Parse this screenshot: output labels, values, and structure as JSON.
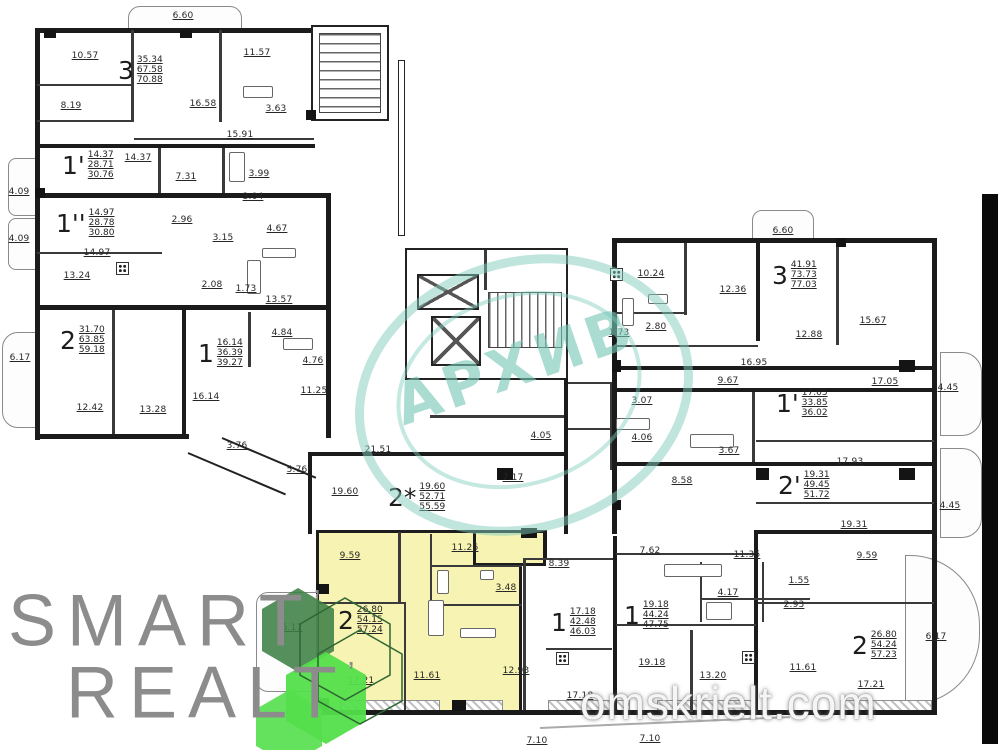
{
  "branding": {
    "logo_line1": "SMART",
    "logo_line2": "REALT",
    "logo_tick": "’",
    "stamp_text": "АРХИВ",
    "site_watermark": "omskrielt.com"
  },
  "colors": {
    "highlight_yellow": "#f7f3b2",
    "stamp_teal": "#7fcbbc",
    "hex_dark_green": "#3e8044",
    "hex_bright_green": "#54df4b",
    "wall_black": "#1b1b1b",
    "logo_gray": "#8c8c8c"
  },
  "apartments": [
    {
      "id": "apt-3-top-left",
      "number": "3",
      "values": [
        "35.34",
        "67.58",
        "70.88"
      ],
      "x": 118,
      "y": 55
    },
    {
      "id": "apt-1p-left",
      "number": "1'",
      "values": [
        "14.37",
        "28.71",
        "30.76"
      ],
      "x": 62,
      "y": 150
    },
    {
      "id": "apt-1pp-left",
      "number": "1''",
      "values": [
        "14.97",
        "28.78",
        "30.80"
      ],
      "x": 56,
      "y": 208
    },
    {
      "id": "apt-2-left",
      "number": "2",
      "values": [
        "31.70",
        "63.85",
        "59.18"
      ],
      "x": 60,
      "y": 325
    },
    {
      "id": "apt-1-left",
      "number": "1",
      "values": [
        "16.14",
        "36.39",
        "39.27"
      ],
      "x": 198,
      "y": 338
    },
    {
      "id": "apt-2star-center",
      "number": "2*",
      "values": [
        "19.60",
        "52.71",
        "55.59"
      ],
      "x": 388,
      "y": 482
    },
    {
      "id": "apt-3-right",
      "number": "3",
      "values": [
        "41.91",
        "73.73",
        "77.03"
      ],
      "x": 772,
      "y": 260
    },
    {
      "id": "apt-1p-right",
      "number": "1'",
      "values": [
        "17.05",
        "33.85",
        "36.02"
      ],
      "x": 776,
      "y": 388
    },
    {
      "id": "apt-2p-right",
      "number": "2'",
      "values": [
        "19.31",
        "49.45",
        "51.72"
      ],
      "x": 778,
      "y": 470
    },
    {
      "id": "apt-2-highlight",
      "number": "2",
      "values": [
        "26.80",
        "54.15",
        "57.24"
      ],
      "x": 338,
      "y": 605
    },
    {
      "id": "apt-1-bottom-a",
      "number": "1",
      "values": [
        "17.18",
        "42.48",
        "46.03"
      ],
      "x": 551,
      "y": 607
    },
    {
      "id": "apt-1-bottom-b",
      "number": "1",
      "values": [
        "19.18",
        "44.24",
        "47.75"
      ],
      "x": 624,
      "y": 600
    },
    {
      "id": "apt-2-bottom-right",
      "number": "2",
      "values": [
        "26.80",
        "54.24",
        "57.23"
      ],
      "x": 852,
      "y": 630
    }
  ],
  "room_labels": [
    {
      "t": "6.60",
      "x": 183,
      "y": 16
    },
    {
      "t": "10.57",
      "x": 85,
      "y": 56
    },
    {
      "t": "11.57",
      "x": 257,
      "y": 53
    },
    {
      "t": "16.58",
      "x": 203,
      "y": 104
    },
    {
      "t": "8.19",
      "x": 71,
      "y": 106
    },
    {
      "t": "3.63",
      "x": 276,
      "y": 109
    },
    {
      "t": "15.91",
      "x": 240,
      "y": 135
    },
    {
      "t": "14.37",
      "x": 138,
      "y": 158
    },
    {
      "t": "7.31",
      "x": 186,
      "y": 177
    },
    {
      "t": "3.99",
      "x": 259,
      "y": 174
    },
    {
      "t": "3.04",
      "x": 253,
      "y": 197
    },
    {
      "t": "4.09",
      "x": 19,
      "y": 192
    },
    {
      "t": "4.09",
      "x": 19,
      "y": 239
    },
    {
      "t": "14.97",
      "x": 97,
      "y": 253
    },
    {
      "t": "2.96",
      "x": 182,
      "y": 220
    },
    {
      "t": "3.15",
      "x": 223,
      "y": 238
    },
    {
      "t": "4.67",
      "x": 277,
      "y": 229
    },
    {
      "t": "2.08",
      "x": 212,
      "y": 285
    },
    {
      "t": "1.73",
      "x": 246,
      "y": 289
    },
    {
      "t": "13.24",
      "x": 77,
      "y": 276
    },
    {
      "t": "13.57",
      "x": 279,
      "y": 300
    },
    {
      "t": "6.17",
      "x": 20,
      "y": 358
    },
    {
      "t": "12.42",
      "x": 90,
      "y": 408
    },
    {
      "t": "13.28",
      "x": 153,
      "y": 410
    },
    {
      "t": "16.14",
      "x": 206,
      "y": 397
    },
    {
      "t": "4.84",
      "x": 282,
      "y": 333
    },
    {
      "t": "4.76",
      "x": 313,
      "y": 361
    },
    {
      "t": "11.25",
      "x": 314,
      "y": 391
    },
    {
      "t": "3.76",
      "x": 237,
      "y": 446
    },
    {
      "t": "5.76",
      "x": 297,
      "y": 470
    },
    {
      "t": "21.51",
      "x": 378,
      "y": 450
    },
    {
      "t": "4.05",
      "x": 541,
      "y": 436
    },
    {
      "t": "7.17",
      "x": 513,
      "y": 478
    },
    {
      "t": "19.60",
      "x": 345,
      "y": 492
    },
    {
      "t": "11.26",
      "x": 465,
      "y": 548
    },
    {
      "t": "9.59",
      "x": 350,
      "y": 556
    },
    {
      "t": "3.48",
      "x": 506,
      "y": 588
    },
    {
      "t": "11.61",
      "x": 427,
      "y": 676
    },
    {
      "t": "17.21",
      "x": 361,
      "y": 681
    },
    {
      "t": "8.39",
      "x": 559,
      "y": 564
    },
    {
      "t": "6.17",
      "x": 292,
      "y": 628
    },
    {
      "t": "12.93",
      "x": 516,
      "y": 671
    },
    {
      "t": "17.18",
      "x": 580,
      "y": 696
    },
    {
      "t": "7.10",
      "x": 537,
      "y": 741
    },
    {
      "t": "7.10",
      "x": 650,
      "y": 739
    },
    {
      "t": "6.60",
      "x": 783,
      "y": 231
    },
    {
      "t": "10.24",
      "x": 651,
      "y": 274
    },
    {
      "t": "12.36",
      "x": 733,
      "y": 290
    },
    {
      "t": "2.80",
      "x": 656,
      "y": 327
    },
    {
      "t": "1.73",
      "x": 619,
      "y": 333
    },
    {
      "t": "15.67",
      "x": 873,
      "y": 321
    },
    {
      "t": "12.88",
      "x": 809,
      "y": 335
    },
    {
      "t": "16.95",
      "x": 754,
      "y": 363
    },
    {
      "t": "9.67",
      "x": 728,
      "y": 381
    },
    {
      "t": "17.05",
      "x": 885,
      "y": 382
    },
    {
      "t": "3.07",
      "x": 642,
      "y": 401
    },
    {
      "t": "4.06",
      "x": 642,
      "y": 438
    },
    {
      "t": "3.67",
      "x": 729,
      "y": 451
    },
    {
      "t": "17.93",
      "x": 850,
      "y": 462
    },
    {
      "t": "8.58",
      "x": 682,
      "y": 481
    },
    {
      "t": "19.31",
      "x": 854,
      "y": 525
    },
    {
      "t": "4.45",
      "x": 948,
      "y": 388
    },
    {
      "t": "4.45",
      "x": 950,
      "y": 506
    },
    {
      "t": "7.62",
      "x": 650,
      "y": 551
    },
    {
      "t": "11.35",
      "x": 747,
      "y": 555
    },
    {
      "t": "9.59",
      "x": 867,
      "y": 556
    },
    {
      "t": "4.17",
      "x": 728,
      "y": 593
    },
    {
      "t": "1.55",
      "x": 799,
      "y": 581
    },
    {
      "t": "2.93",
      "x": 794,
      "y": 605
    },
    {
      "t": "19.18",
      "x": 652,
      "y": 663
    },
    {
      "t": "13.20",
      "x": 713,
      "y": 676
    },
    {
      "t": "11.61",
      "x": 803,
      "y": 668
    },
    {
      "t": "17.21",
      "x": 871,
      "y": 685
    },
    {
      "t": "6.17",
      "x": 936,
      "y": 637
    }
  ]
}
